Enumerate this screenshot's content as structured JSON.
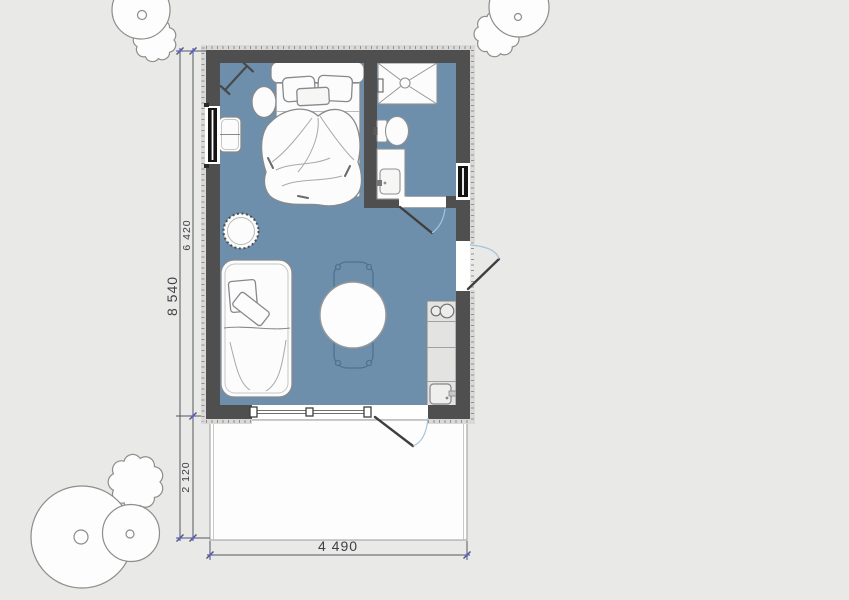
{
  "plan": {
    "dimensions": {
      "overall_height": "8 540",
      "interior_height": "6 420",
      "terrace_depth": "2 120",
      "overall_width": "4 490"
    }
  },
  "colors": {
    "background": "#e9e9e8",
    "floor": "#6d8fac",
    "wall": "#4f4f4f",
    "band": "#dad9d7",
    "band_dash": "#90908e",
    "counter": "#e3e3e1",
    "door_arc": "#a6c3da",
    "dim": "#55585c",
    "marker": "#5a5ecb",
    "tree": "#8d8d8b",
    "furn": "#87898c",
    "chair": "#50728f"
  }
}
